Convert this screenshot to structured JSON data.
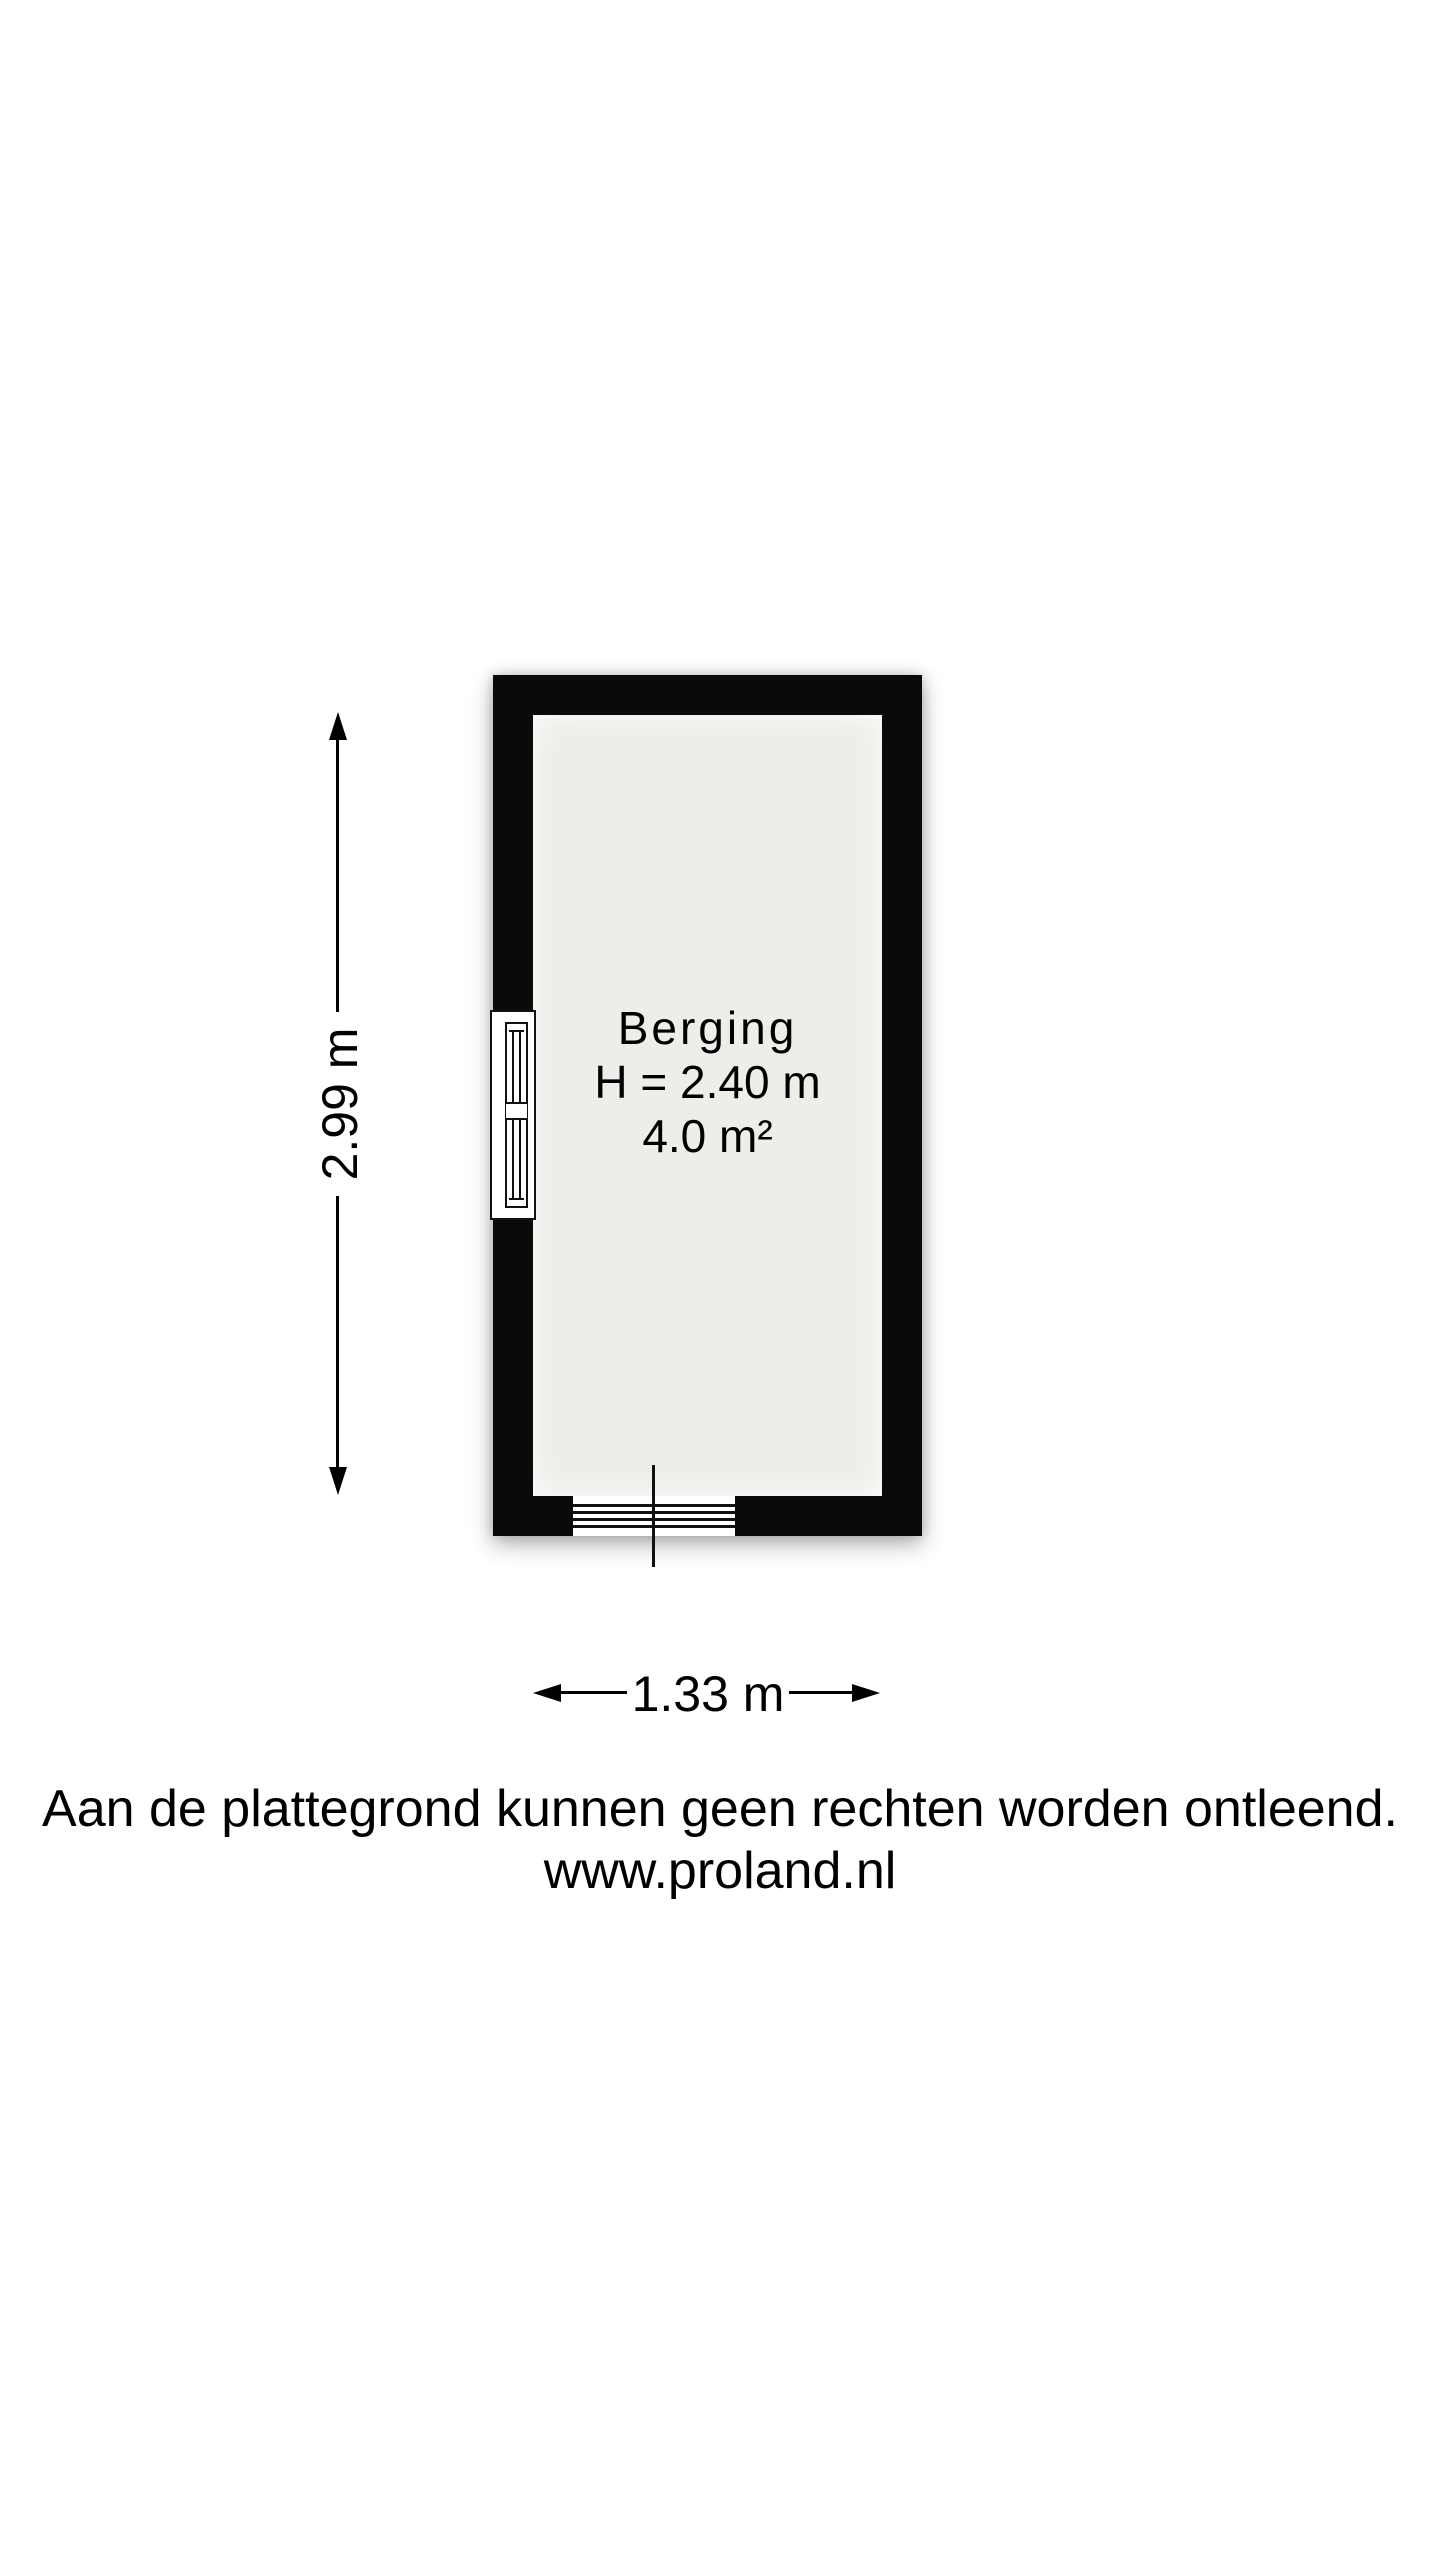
{
  "floor_plan": {
    "room": {
      "name": "Berging",
      "ceiling_height": "H = 2.40 m",
      "floor_area": "4.0 m²"
    },
    "dimensions": {
      "height_label": "2.99 m",
      "width_label": "1.33 m"
    },
    "colors": {
      "wall": "#0a0a0a",
      "floor": "#efede9",
      "background": "#ffffff"
    }
  },
  "footer": {
    "disclaimer": "Aan de plattegrond kunnen geen rechten worden ontleend.",
    "website": "www.proland.nl"
  }
}
